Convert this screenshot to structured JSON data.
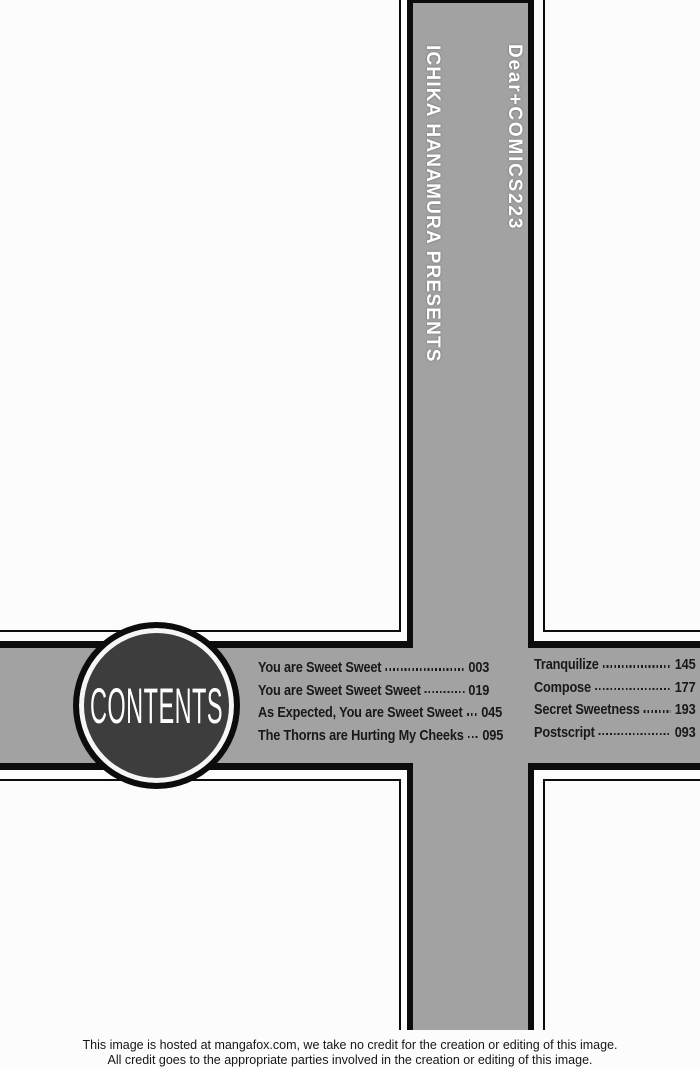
{
  "spine": {
    "series_label": "Dear+COMICS223",
    "presents_label": "ICHIKA HANAMURA PRESENTS"
  },
  "contents": {
    "title": "CONTENTS",
    "left_entries": [
      {
        "title": "You are Sweet Sweet",
        "page": "003"
      },
      {
        "title": "You are Sweet Sweet Sweet",
        "page": "019"
      },
      {
        "title": "As Expected, You are Sweet Sweet",
        "page": "045"
      },
      {
        "title": "The Thorns are Hurting My Cheeks",
        "page": "095"
      }
    ],
    "right_entries": [
      {
        "title": "Tranquilize",
        "page": "145"
      },
      {
        "title": "Compose",
        "page": "177"
      },
      {
        "title": "Secret Sweetness",
        "page": "193"
      },
      {
        "title": "Postscript",
        "page": "093"
      }
    ]
  },
  "footer": {
    "line1": "This image is hosted at mangafox.com, we take no credit for the creation or editing of this image.",
    "line2": "All credit goes to the appropriate parties involved in the creation or editing of this image."
  },
  "colors": {
    "band_gray": "#a2a2a2",
    "badge_disc": "#3d3d3d",
    "ink": "#0c0c0c",
    "background": "#fcfcfc"
  }
}
